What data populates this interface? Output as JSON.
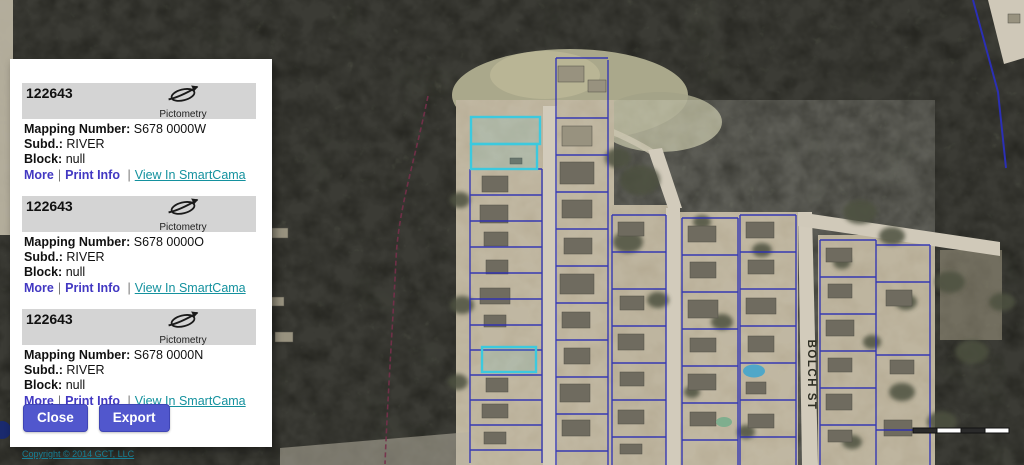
{
  "panel": {
    "records": [
      {
        "id": "122643",
        "logo": "Pictometry",
        "fields": [
          [
            "Mapping Number:",
            "S678 0000W"
          ],
          [
            "Subd.:",
            "RIVER"
          ],
          [
            "Block:",
            "null"
          ]
        ],
        "links": {
          "more": "More",
          "print": "Print Info",
          "smartcama": "View In SmartCama"
        }
      },
      {
        "id": "122643",
        "logo": "Pictometry",
        "fields": [
          [
            "Mapping Number:",
            "S678 0000O"
          ],
          [
            "Subd.:",
            "RIVER"
          ],
          [
            "Block:",
            "null"
          ]
        ],
        "links": {
          "more": "More",
          "print": "Print Info",
          "smartcama": "View In SmartCama"
        }
      },
      {
        "id": "122643",
        "logo": "Pictometry",
        "fields": [
          [
            "Mapping Number:",
            "S678 0000N"
          ],
          [
            "Subd.:",
            "RIVER"
          ],
          [
            "Block:",
            "null"
          ]
        ],
        "links": {
          "more": "More",
          "print": "Print Info",
          "smartcama": "View In SmartCama"
        }
      }
    ],
    "link_separator": "|",
    "buttons": {
      "close": "Close",
      "export": "Export"
    }
  },
  "map": {
    "street_label": "BOLCH ST",
    "copyright": "Copyright © 2014 GCT, LLC"
  },
  "colors": {
    "parcel_line": "#2b2fb4",
    "highlight_parcel": "#3cc9de",
    "trail": "#76304a",
    "button": "#5157cd",
    "link_blue": "#4238c2",
    "link_teal": "#14919e",
    "header_bar": "#d4d4d4"
  }
}
